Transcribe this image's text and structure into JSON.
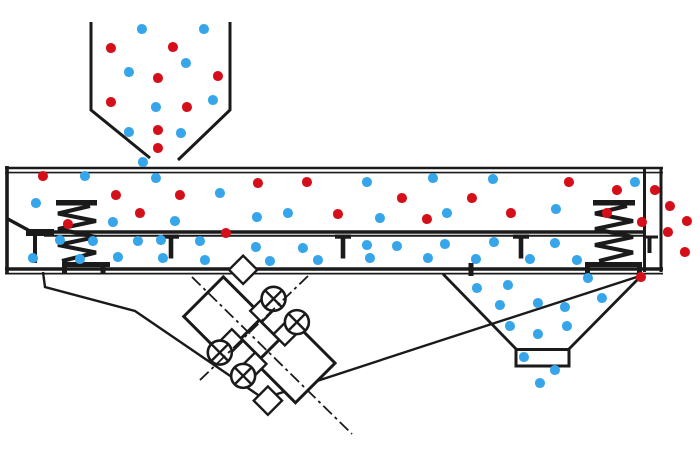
{
  "diagram": {
    "kind": "vibrating-screen-separator",
    "colors": {
      "line": "#1a1a1a",
      "coarse_particle": "#d50f1a",
      "fine_particle": "#36a5ea",
      "background": "#ffffff"
    },
    "dot_diameter": 10,
    "springs": [
      {
        "cx": 77,
        "top_plate": [
          56,
          97
        ],
        "bottom_plate": [
          62,
          110
        ],
        "feet": [
          64.5,
          103
        ]
      },
      {
        "cx": 614,
        "top_plate": [
          593,
          635
        ],
        "bottom_plate": [
          585,
          642
        ],
        "feet": [
          587.5,
          639.5
        ]
      }
    ],
    "mesh_hangers": [
      171,
      343,
      521
    ],
    "eccentric_weights": [
      [
        -33,
        -38
      ],
      [
        0,
        -38
      ],
      [
        -33,
        38
      ],
      [
        0,
        38
      ]
    ],
    "particles": {
      "feed_hopper": [
        [
          142,
          29,
          "b"
        ],
        [
          204,
          29,
          "b"
        ],
        [
          111,
          48,
          "r"
        ],
        [
          173,
          47,
          "r"
        ],
        [
          186,
          63,
          "b"
        ],
        [
          129,
          72,
          "b"
        ],
        [
          158,
          78,
          "r"
        ],
        [
          218,
          76,
          "r"
        ],
        [
          213,
          100,
          "b"
        ],
        [
          111,
          102,
          "r"
        ],
        [
          156,
          107,
          "b"
        ],
        [
          187,
          107,
          "r"
        ],
        [
          129,
          132,
          "b"
        ],
        [
          158,
          130,
          "r"
        ],
        [
          181,
          133,
          "b"
        ],
        [
          158,
          148,
          "r"
        ]
      ],
      "deck_above_mesh": [
        [
          143,
          162,
          "b"
        ],
        [
          43,
          176,
          "r"
        ],
        [
          85,
          176,
          "b"
        ],
        [
          156,
          178,
          "b"
        ],
        [
          258,
          183,
          "r"
        ],
        [
          307,
          182,
          "r"
        ],
        [
          367,
          182,
          "b"
        ],
        [
          433,
          178,
          "b"
        ],
        [
          493,
          179,
          "b"
        ],
        [
          569,
          182,
          "r"
        ],
        [
          617,
          190,
          "r"
        ],
        [
          635,
          182,
          "b"
        ],
        [
          36,
          203,
          "b"
        ],
        [
          116,
          195,
          "r"
        ],
        [
          180,
          195,
          "r"
        ],
        [
          220,
          193,
          "b"
        ],
        [
          402,
          198,
          "r"
        ],
        [
          472,
          198,
          "r"
        ],
        [
          140,
          213,
          "r"
        ],
        [
          113,
          222,
          "b"
        ],
        [
          175,
          221,
          "b"
        ],
        [
          68,
          224,
          "r"
        ],
        [
          257,
          217,
          "b"
        ],
        [
          288,
          213,
          "b"
        ],
        [
          338,
          214,
          "r"
        ],
        [
          380,
          218,
          "b"
        ],
        [
          427,
          219,
          "r"
        ],
        [
          447,
          213,
          "b"
        ],
        [
          511,
          213,
          "r"
        ],
        [
          556,
          209,
          "b"
        ],
        [
          607,
          213,
          "r"
        ],
        [
          642,
          222,
          "r"
        ],
        [
          226,
          233,
          "r"
        ]
      ],
      "deck_below_mesh": [
        [
          60,
          240,
          "b"
        ],
        [
          93,
          241,
          "b"
        ],
        [
          138,
          241,
          "b"
        ],
        [
          161,
          240,
          "b"
        ],
        [
          200,
          241,
          "b"
        ],
        [
          256,
          247,
          "b"
        ],
        [
          303,
          248,
          "b"
        ],
        [
          367,
          245,
          "b"
        ],
        [
          397,
          246,
          "b"
        ],
        [
          445,
          244,
          "b"
        ],
        [
          494,
          242,
          "b"
        ],
        [
          555,
          243,
          "b"
        ],
        [
          33,
          258,
          "b"
        ],
        [
          80,
          259,
          "b"
        ],
        [
          118,
          257,
          "b"
        ],
        [
          163,
          258,
          "b"
        ],
        [
          205,
          260,
          "b"
        ],
        [
          270,
          261,
          "b"
        ],
        [
          318,
          260,
          "b"
        ],
        [
          370,
          258,
          "b"
        ],
        [
          428,
          258,
          "b"
        ],
        [
          476,
          259,
          "b"
        ],
        [
          530,
          259,
          "b"
        ],
        [
          577,
          260,
          "b"
        ]
      ],
      "fines_hopper": [
        [
          588,
          278,
          "b"
        ],
        [
          508,
          285,
          "b"
        ],
        [
          477,
          288,
          "b"
        ],
        [
          602,
          298,
          "b"
        ],
        [
          500,
          305,
          "b"
        ],
        [
          538,
          303,
          "b"
        ],
        [
          565,
          307,
          "b"
        ],
        [
          510,
          326,
          "b"
        ],
        [
          538,
          334,
          "b"
        ],
        [
          567,
          326,
          "b"
        ],
        [
          524,
          357,
          "b"
        ],
        [
          555,
          370,
          "b"
        ],
        [
          540,
          383,
          "b"
        ]
      ],
      "oversize_discharge": [
        [
          655,
          190,
          "r"
        ],
        [
          670,
          206,
          "r"
        ],
        [
          687,
          221,
          "r"
        ],
        [
          668,
          232,
          "r"
        ],
        [
          685,
          252,
          "r"
        ],
        [
          641,
          277,
          "r"
        ]
      ]
    }
  }
}
